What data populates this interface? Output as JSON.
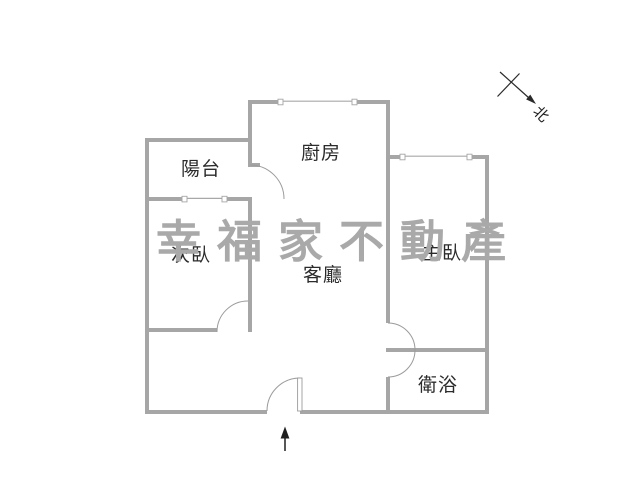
{
  "page": {
    "background": "#ffffff",
    "type": "floor-plan"
  },
  "watermark": {
    "text": "幸福家不動產",
    "color": "#a9a9a9"
  },
  "rooms": {
    "balcony": "陽台",
    "kitchen": "廚房",
    "second_bedroom": "次臥",
    "living_room": "客廳",
    "master_bedroom": "主臥",
    "bathroom": "衛浴"
  },
  "compass": {
    "north_label": "北"
  },
  "colors": {
    "wall": "#a6a6a6",
    "door_window_line": "#9b9b9b",
    "room_label_text": "#2b2b2b",
    "compass_and_arrow": "#2a2a2a",
    "watermark": "#a9a9a9"
  }
}
